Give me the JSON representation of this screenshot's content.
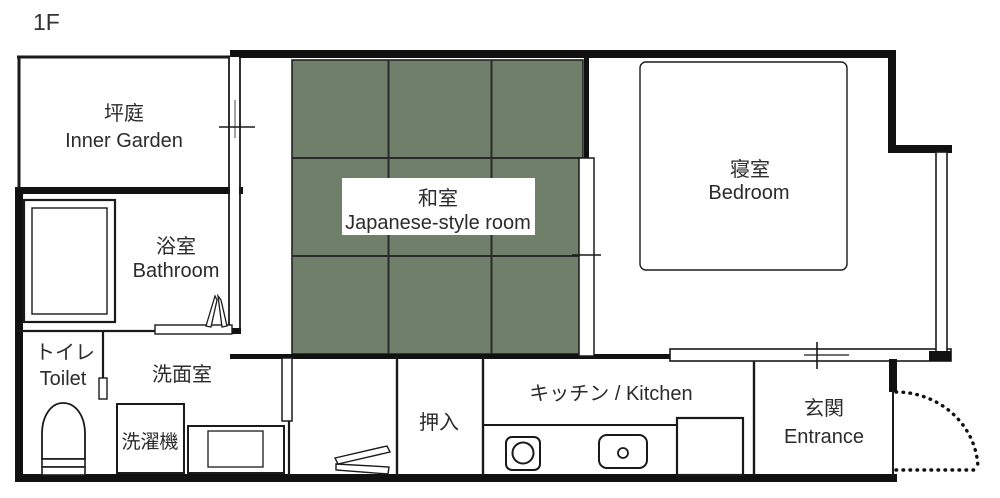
{
  "floor_label": "1F",
  "rooms": {
    "inner_garden": {
      "ja": "坪庭",
      "en": "Inner Garden"
    },
    "bathroom": {
      "ja": "浴室",
      "en": "Bathroom"
    },
    "toilet": {
      "ja": "トイレ",
      "en": "Toilet"
    },
    "washroom": {
      "ja": "洗面室"
    },
    "japanese_room": {
      "ja": "和室",
      "en": "Japanese-style room"
    },
    "bedroom": {
      "ja": "寝室",
      "en": "Bedroom"
    },
    "closet": {
      "ja": "押入"
    },
    "kitchen": {
      "label": "キッチン / Kitchen"
    },
    "entrance": {
      "ja": "玄関",
      "en": "Entrance"
    }
  },
  "fixtures": {
    "washing_machine": {
      "ja": "洗濯機"
    }
  },
  "colors": {
    "background": "#ffffff",
    "wall_black": "#111111",
    "tatami_green": "#6f7f6a",
    "tatami_grid": "#2b2b2b"
  }
}
